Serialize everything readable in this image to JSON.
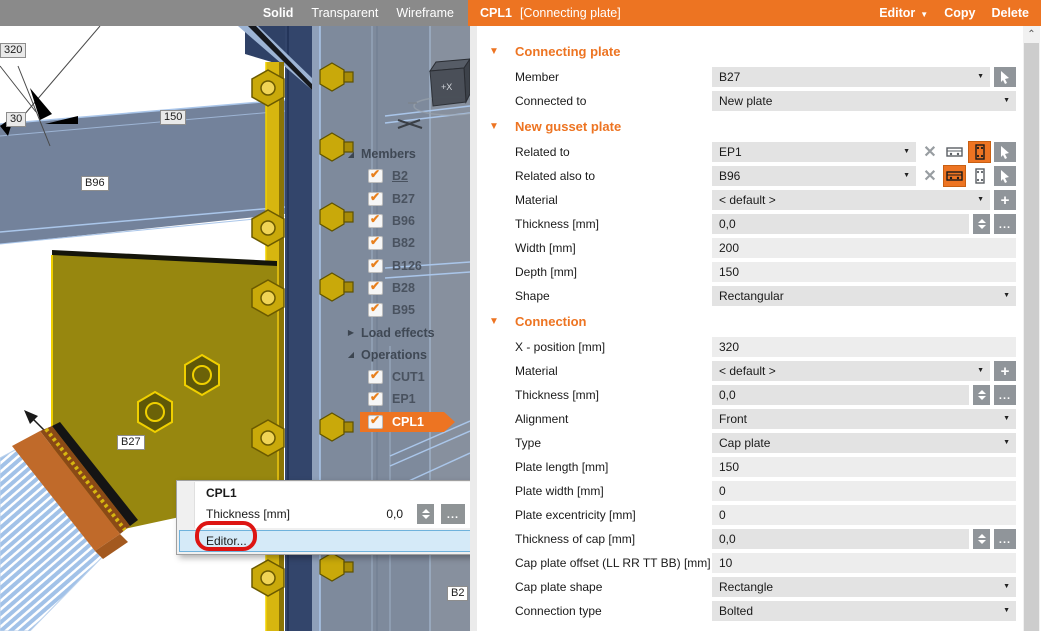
{
  "colors": {
    "accent": "#ed7422",
    "selection_blue": "#d5eaf8",
    "annotation_red": "#dd1412",
    "toolbar_gray": "#8a8a8a"
  },
  "topbar": {
    "view_modes": [
      {
        "label": "Solid",
        "active": true
      },
      {
        "label": "Transparent",
        "active": false
      },
      {
        "label": "Wireframe",
        "active": false
      }
    ],
    "title": "CPL1",
    "subtitle": "[Connecting plate]",
    "actions": [
      {
        "label": "Editor",
        "dropdown": true
      },
      {
        "label": "Copy",
        "dropdown": false
      },
      {
        "label": "Delete",
        "dropdown": false
      }
    ]
  },
  "viewport": {
    "axis_cube_label": "+X",
    "dim_labels": [
      {
        "text": "320",
        "x": 0,
        "y": 17
      },
      {
        "text": "30",
        "x": 6,
        "y": 86
      },
      {
        "text": "150",
        "x": 160,
        "y": 84
      }
    ],
    "member_labels": [
      {
        "text": "B96",
        "x": 81,
        "y": 150
      },
      {
        "text": "B27",
        "x": 117,
        "y": 409
      },
      {
        "text": "B2",
        "x": 447,
        "y": 560
      }
    ]
  },
  "tree": {
    "items": [
      {
        "kind": "group",
        "label": "Members",
        "state": "expanded"
      },
      {
        "kind": "item",
        "label": "B2",
        "checked": true,
        "underline": true
      },
      {
        "kind": "item",
        "label": "B27",
        "checked": true
      },
      {
        "kind": "item",
        "label": "B96",
        "checked": true
      },
      {
        "kind": "item",
        "label": "B82",
        "checked": true
      },
      {
        "kind": "item",
        "label": "B126",
        "checked": true
      },
      {
        "kind": "item",
        "label": "B28",
        "checked": true
      },
      {
        "kind": "item",
        "label": "B95",
        "checked": true
      },
      {
        "kind": "group",
        "label": "Load effects",
        "state": "collapsed"
      },
      {
        "kind": "group",
        "label": "Operations",
        "state": "expanded"
      },
      {
        "kind": "item",
        "label": "CUT1",
        "checked": true
      },
      {
        "kind": "item",
        "label": "EP1",
        "checked": true
      },
      {
        "kind": "item",
        "label": "CPL1",
        "checked": true,
        "selected": true
      }
    ]
  },
  "popup": {
    "title": "CPL1",
    "row_label": "Thickness [mm]",
    "row_value": "0,0",
    "menu_item": "Editor..."
  },
  "panel": {
    "rows": [
      {
        "kind": "section",
        "label": "Connecting plate"
      },
      {
        "kind": "field",
        "label": "Member",
        "value": "B27",
        "dropdown": true,
        "shade": "dark",
        "controls": [
          {
            "type": "pick"
          }
        ]
      },
      {
        "kind": "field",
        "label": "Connected to",
        "value": "New plate",
        "dropdown": true,
        "shade": "dark",
        "controls": []
      },
      {
        "kind": "section",
        "label": "New gusset plate"
      },
      {
        "kind": "field",
        "label": "Related to",
        "value": "EP1",
        "dropdown": true,
        "shade": "dark",
        "controls": [
          {
            "type": "delete-x"
          },
          {
            "type": "plate-front"
          },
          {
            "type": "plate-side",
            "active": true
          },
          {
            "type": "pick"
          }
        ]
      },
      {
        "kind": "field",
        "label": "Related also to",
        "value": "B96",
        "dropdown": true,
        "shade": "dark",
        "controls": [
          {
            "type": "delete-x"
          },
          {
            "type": "plate-front",
            "active": true
          },
          {
            "type": "plate-side"
          },
          {
            "type": "pick"
          }
        ]
      },
      {
        "kind": "field",
        "label": "Material",
        "value": "< default >",
        "dropdown": true,
        "shade": "dark",
        "controls": [
          {
            "type": "plus"
          }
        ]
      },
      {
        "kind": "field",
        "label": "Thickness [mm]",
        "value": "0,0",
        "dropdown": false,
        "shade": "dark",
        "controls": [
          {
            "type": "spinner"
          },
          {
            "type": "dots"
          }
        ]
      },
      {
        "kind": "field",
        "label": "Width [mm]",
        "value": "200",
        "dropdown": false,
        "shade": "light",
        "controls": []
      },
      {
        "kind": "field",
        "label": "Depth [mm]",
        "value": "150",
        "dropdown": false,
        "shade": "light",
        "controls": []
      },
      {
        "kind": "field",
        "label": "Shape",
        "value": "Rectangular",
        "dropdown": true,
        "shade": "dark",
        "controls": []
      },
      {
        "kind": "section",
        "label": "Connection"
      },
      {
        "kind": "field",
        "label": "X - position [mm]",
        "value": "320",
        "dropdown": false,
        "shade": "light",
        "controls": []
      },
      {
        "kind": "field",
        "label": "Material",
        "value": "< default >",
        "dropdown": true,
        "shade": "dark",
        "controls": [
          {
            "type": "plus"
          }
        ]
      },
      {
        "kind": "field",
        "label": "Thickness [mm]",
        "value": "0,0",
        "dropdown": false,
        "shade": "dark",
        "controls": [
          {
            "type": "spinner"
          },
          {
            "type": "dots"
          }
        ]
      },
      {
        "kind": "field",
        "label": "Alignment",
        "value": "Front",
        "dropdown": true,
        "shade": "dark",
        "controls": []
      },
      {
        "kind": "field",
        "label": "Type",
        "value": "Cap plate",
        "dropdown": true,
        "shade": "dark",
        "controls": []
      },
      {
        "kind": "field",
        "label": "Plate length [mm]",
        "value": "150",
        "dropdown": false,
        "shade": "light",
        "controls": []
      },
      {
        "kind": "field",
        "label": "Plate width [mm]",
        "value": "0",
        "dropdown": false,
        "shade": "light",
        "controls": []
      },
      {
        "kind": "field",
        "label": "Plate excentricity [mm]",
        "value": "0",
        "dropdown": false,
        "shade": "light",
        "controls": []
      },
      {
        "kind": "field",
        "label": "Thickness of cap [mm]",
        "value": "0,0",
        "dropdown": false,
        "shade": "dark",
        "controls": [
          {
            "type": "spinner"
          },
          {
            "type": "dots"
          }
        ]
      },
      {
        "kind": "field",
        "label": "Cap plate offset (LL RR TT BB) [mm]",
        "value": "10",
        "dropdown": false,
        "shade": "light",
        "controls": []
      },
      {
        "kind": "field",
        "label": "Cap plate shape",
        "value": "Rectangle",
        "dropdown": true,
        "shade": "dark",
        "controls": []
      },
      {
        "kind": "field",
        "label": "Connection type",
        "value": "Bolted",
        "dropdown": true,
        "shade": "dark",
        "controls": []
      }
    ]
  }
}
